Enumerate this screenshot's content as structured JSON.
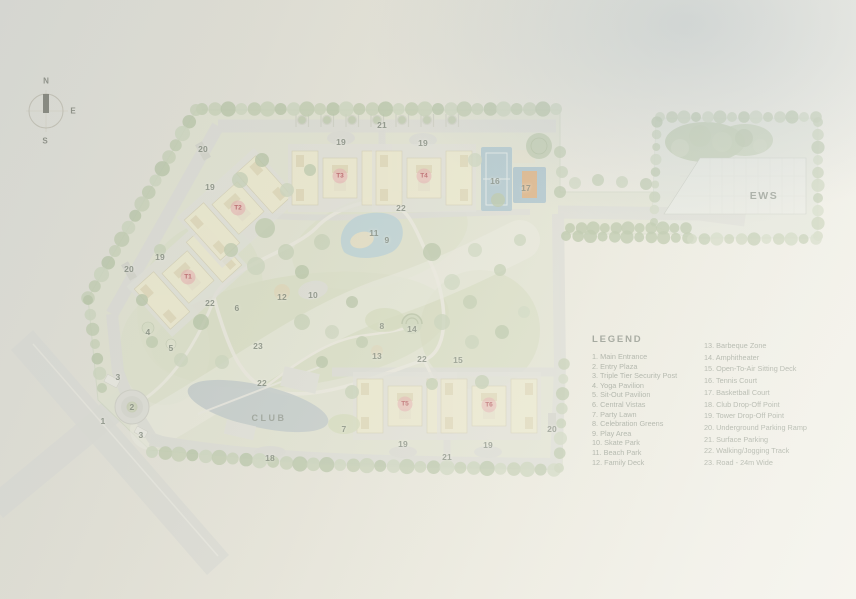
{
  "compass": {
    "north": "N",
    "east": "E",
    "south": "S"
  },
  "map_labels": {
    "ews": "EWS",
    "club": "CLUB"
  },
  "legend": {
    "title": "LEGEND",
    "column1": [
      "1. Main Entrance",
      "2. Entry Plaza",
      "3. Triple Tier Security Post",
      "4. Yoga Pavilion",
      "5. Sit-Out Pavilion",
      "6. Central Vistas",
      "7. Party Lawn",
      "8. Celebration Greens",
      "9. Play Area",
      "10. Skate Park",
      "11. Beach Park",
      "12. Family Deck"
    ],
    "column2": [
      "13. Barbeque Zone",
      "14. Amphitheater",
      "15. Open-To-Air Sitting Deck",
      "16. Tennis Court",
      "17. Basketball Court",
      "18. Club Drop-Off Point",
      "19. Tower Drop-Off Point",
      "20. Underground Parking Ramp",
      "21. Surface Parking",
      "22. Walking/Jogging Track",
      "23. Road - 24m Wide"
    ]
  },
  "tower_badges": [
    {
      "label": "T1",
      "x": 188,
      "y": 277
    },
    {
      "label": "T2",
      "x": 238,
      "y": 208
    },
    {
      "label": "T3",
      "x": 340,
      "y": 176
    },
    {
      "label": "T4",
      "x": 424,
      "y": 176
    },
    {
      "label": "T5",
      "x": 405,
      "y": 404
    },
    {
      "label": "T6",
      "x": 489,
      "y": 405
    }
  ],
  "map_markers": [
    {
      "t": "1",
      "x": 103,
      "y": 421
    },
    {
      "t": "2",
      "x": 132,
      "y": 407
    },
    {
      "t": "3",
      "x": 118,
      "y": 377
    },
    {
      "t": "3",
      "x": 141,
      "y": 435
    },
    {
      "t": "4",
      "x": 148,
      "y": 332
    },
    {
      "t": "5",
      "x": 171,
      "y": 348
    },
    {
      "t": "6",
      "x": 237,
      "y": 308
    },
    {
      "t": "7",
      "x": 344,
      "y": 429
    },
    {
      "t": "8",
      "x": 382,
      "y": 326
    },
    {
      "t": "9",
      "x": 387,
      "y": 240
    },
    {
      "t": "10",
      "x": 313,
      "y": 295
    },
    {
      "t": "11",
      "x": 374,
      "y": 233
    },
    {
      "t": "12",
      "x": 282,
      "y": 297
    },
    {
      "t": "13",
      "x": 377,
      "y": 356
    },
    {
      "t": "14",
      "x": 412,
      "y": 329
    },
    {
      "t": "15",
      "x": 458,
      "y": 360
    },
    {
      "t": "16",
      "x": 495,
      "y": 181
    },
    {
      "t": "17",
      "x": 526,
      "y": 188
    },
    {
      "t": "18",
      "x": 270,
      "y": 458
    },
    {
      "t": "19",
      "x": 341,
      "y": 142
    },
    {
      "t": "19",
      "x": 423,
      "y": 143
    },
    {
      "t": "19",
      "x": 210,
      "y": 187
    },
    {
      "t": "19",
      "x": 160,
      "y": 257
    },
    {
      "t": "19",
      "x": 403,
      "y": 444
    },
    {
      "t": "19",
      "x": 488,
      "y": 445
    },
    {
      "t": "20",
      "x": 203,
      "y": 149
    },
    {
      "t": "20",
      "x": 129,
      "y": 269
    },
    {
      "t": "20",
      "x": 552,
      "y": 429
    },
    {
      "t": "21",
      "x": 382,
      "y": 125
    },
    {
      "t": "21",
      "x": 447,
      "y": 457
    },
    {
      "t": "22",
      "x": 401,
      "y": 208
    },
    {
      "t": "22",
      "x": 210,
      "y": 303
    },
    {
      "t": "22",
      "x": 262,
      "y": 383
    },
    {
      "t": "22",
      "x": 422,
      "y": 359
    },
    {
      "t": "23",
      "x": 258,
      "y": 346
    }
  ]
}
